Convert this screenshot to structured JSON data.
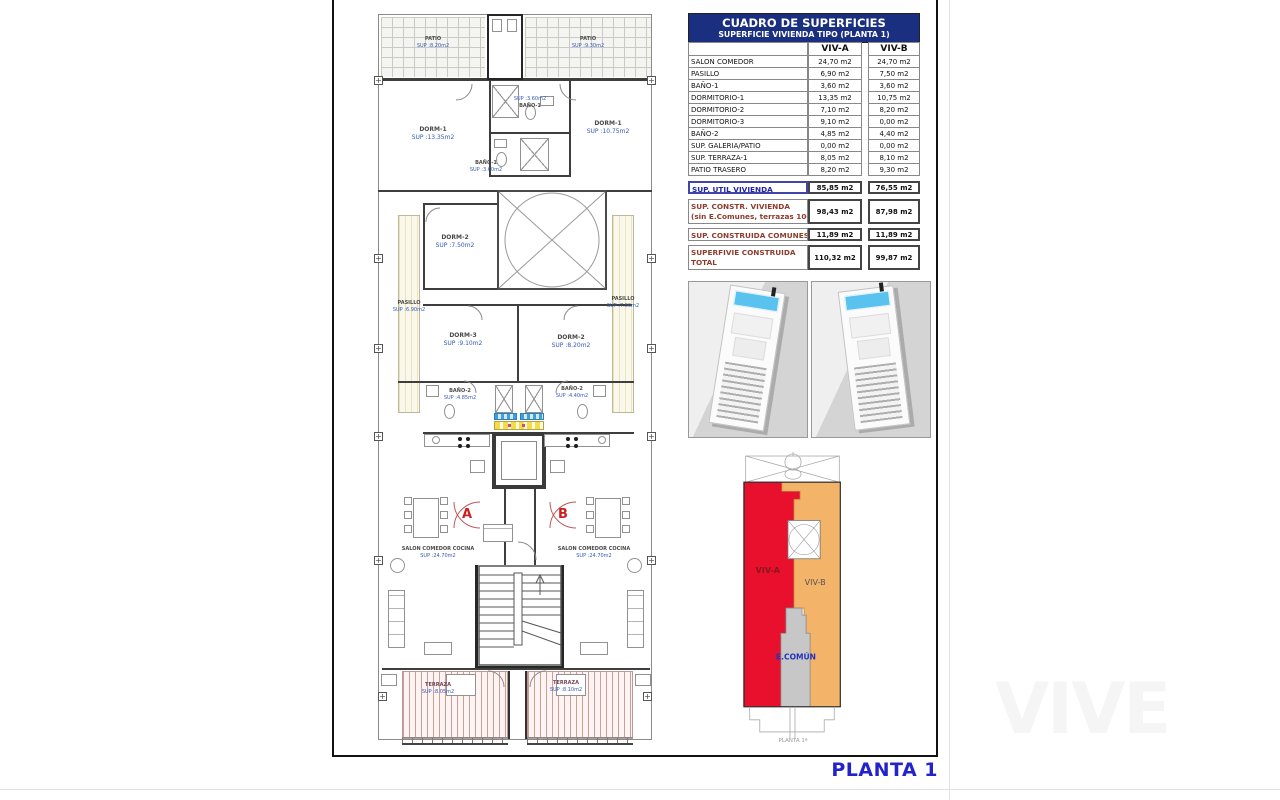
{
  "watermark": "VIVE",
  "footer": {
    "plan_label": "PLANTA 1"
  },
  "plan": {
    "patio_a": {
      "name": "PATIO",
      "sup": "SUP :8.20m2"
    },
    "patio_b": {
      "name": "PATIO",
      "sup": "SUP :9.30m2"
    },
    "dorm1_a": {
      "name": "DORM-1",
      "sup": "SUP :13.35m2"
    },
    "dorm1_b": {
      "name": "DORM-1",
      "sup": "SUP :10.75m2"
    },
    "bano1_b": {
      "name": "BAÑO-1",
      "sup": "SUP :3.60m2"
    },
    "bano1_a": {
      "name": "BAÑO-1",
      "sup": "SUP :3.60m2"
    },
    "dorm2_a": {
      "name": "DORM-2",
      "sup": "SUP :7.50m2"
    },
    "pasillo_a": {
      "name": "PASILLO",
      "sup": "SUP :6.90m2"
    },
    "pasillo_b": {
      "name": "PASILLO",
      "sup": "SUP :7.50m2"
    },
    "dorm3_a": {
      "name": "DORM-3",
      "sup": "SUP :9.10m2"
    },
    "dorm2_b": {
      "name": "DORM-2",
      "sup": "SUP :8.20m2"
    },
    "bano2_a": {
      "name": "BAÑO-2",
      "sup": "SUP :4.85m2"
    },
    "bano2_b": {
      "name": "BAÑO-2",
      "sup": "SUP :4.40m2"
    },
    "salon_a": {
      "name": "SALON COMEDOR COCINA",
      "sup": "SUP :24.70m2"
    },
    "salon_b": {
      "name": "SALON COMEDOR COCINA",
      "sup": "SUP :24.70m2"
    },
    "terraza_a": {
      "name": "TERRAZA",
      "sup": "SUP :8.05m2"
    },
    "terraza_b": {
      "name": "TERRAZA",
      "sup": "SUP :8.10m2"
    },
    "unit_a": "A",
    "unit_b": "B"
  },
  "surfaces_table": {
    "title": "CUADRO DE SUPERFICIES",
    "subtitle": "SUPERFICIE VIVIENDA TIPO  (PLANTA 1)",
    "col_a": "VIV-A",
    "col_b": "VIV-B",
    "rows": [
      {
        "label": "SALON COMEDOR",
        "a": "24,70 m2",
        "b": "24,70 m2"
      },
      {
        "label": "PASILLO",
        "a": "6,90 m2",
        "b": "7,50 m2"
      },
      {
        "label": "BAÑO-1",
        "a": "3,60 m2",
        "b": "3,60 m2"
      },
      {
        "label": "DORMITORIO-1",
        "a": "13,35 m2",
        "b": "10,75 m2"
      },
      {
        "label": "DORMITORIO-2",
        "a": "7,10 m2",
        "b": "8,20 m2"
      },
      {
        "label": "DORMITORIO-3",
        "a": "9,10 m2",
        "b": "0,00 m2"
      },
      {
        "label": "BAÑO-2",
        "a": "4,85 m2",
        "b": "4,40 m2"
      },
      {
        "label": "SUP. GALERIA/PATIO",
        "a": "0,00 m2",
        "b": "0,00 m2"
      },
      {
        "label": "SUP. TERRAZA-1",
        "a": "8,05 m2",
        "b": "8,10 m2"
      },
      {
        "label": "PATIO TRASERO",
        "a": "8,20 m2",
        "b": "9,30 m2"
      }
    ],
    "summary": [
      {
        "label": "SUP. UTIL VIVIENDA",
        "label2": "",
        "a": "85,85 m2",
        "b": "76,55 m2"
      },
      {
        "label": "SUP. CONSTR. VIVIENDA",
        "label2": "(sin E.Comunes, terrazas 100%)",
        "a": "98,43 m2",
        "b": "87,98 m2"
      },
      {
        "label": "SUP. CONSTRUIDA COMUNES",
        "label2": "",
        "a": "11,89 m2",
        "b": "11,89 m2"
      },
      {
        "label": "SUPERFIVIE CONSTRUIDA",
        "label2": "TOTAL",
        "a": "110,32 m2",
        "b": "99,87 m2"
      }
    ]
  },
  "renders": {
    "left_name": "aerial-render-southwest",
    "right_name": "aerial-render-southeast",
    "pool_color": "#59c2ee"
  },
  "unit_diagram": {
    "viv_a_label": "VIV-A",
    "viv_b_label": "VIV-B",
    "comun_label": "E.COMÚN",
    "caption": "PLANTA 1ª",
    "colors": {
      "viv_a": "#e8102d",
      "viv_b": "#f3b469",
      "comun": "#c7c7c7"
    }
  }
}
